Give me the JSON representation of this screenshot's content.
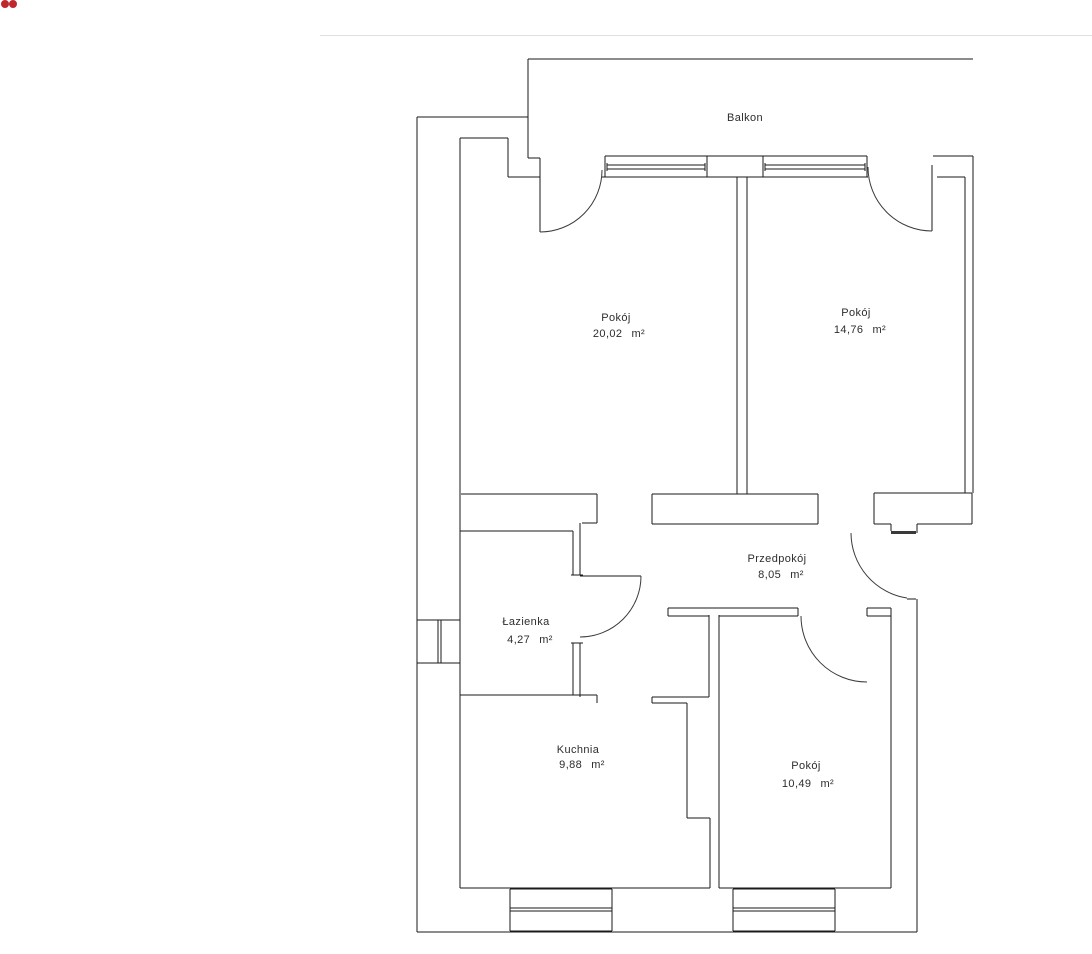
{
  "window_chrome": {
    "red_dots": {
      "count": 2,
      "color": "#c0262c"
    },
    "divider_line_color": "#e0e0e0"
  },
  "floorplan": {
    "balcony": {
      "label": "Balkon"
    },
    "rooms": [
      {
        "name": "Pokój",
        "area": "20,02",
        "unit": "m²"
      },
      {
        "name": "Pokój",
        "area": "14,76",
        "unit": "m²"
      },
      {
        "name": "Przedpokój",
        "area": "8,05",
        "unit": "m²"
      },
      {
        "name": "Łazienka",
        "area": "4,27",
        "unit": "m²"
      },
      {
        "name": "Kuchnia",
        "area": "9,88",
        "unit": "m²"
      },
      {
        "name": "Pokój",
        "area": "10,49",
        "unit": "m²"
      }
    ],
    "line_color": "#1a1a1a",
    "text_color": "#2d2d2d",
    "background": "#ffffff"
  }
}
